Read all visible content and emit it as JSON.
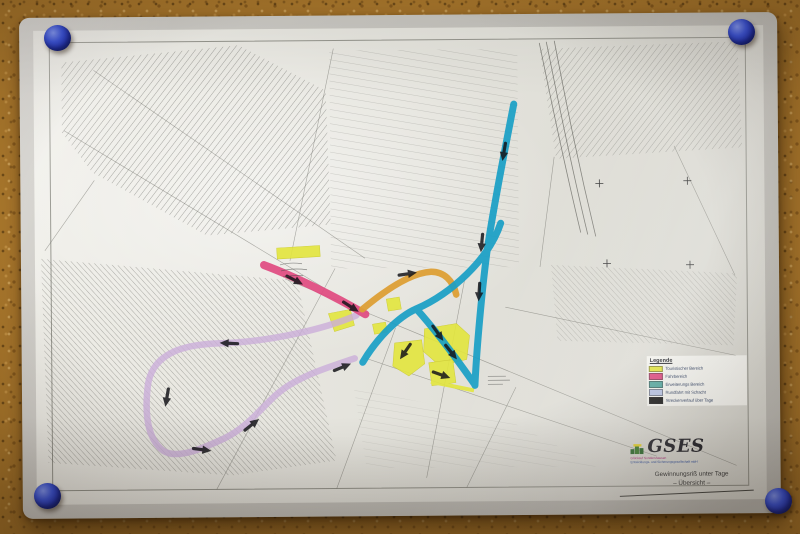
{
  "scene": {
    "description": "Laminated underground mine overview map fixed to a cork board with four round push pins",
    "board_color": "#a9772c",
    "pin_color": "#2b3cc0",
    "icons": {
      "push_pin": "round-head-pin"
    }
  },
  "map": {
    "legend": {
      "title": "Legende",
      "entries": [
        {
          "label": "Touristischer Bereich",
          "color": "#e3e63e"
        },
        {
          "label": "Fahrbereich",
          "color": "#df4a80"
        },
        {
          "label": "Erweiterungs Bereich",
          "color": "#55a8a0"
        },
        {
          "label": "Rundfahrt mit Schacht",
          "color": "#b9c5e6"
        },
        {
          "label": "Streckenverlauf über Tage",
          "color": "#1a1a1a"
        }
      ]
    },
    "title_block": {
      "logo_text": "GSES",
      "logo_subline1": "Glückauf Sondershausen",
      "logo_subline2": "Entwicklungs- und Sicherungsgesellschaft mbH",
      "caption_line1": "Gewinnungsriß unter Tage",
      "caption_line2": "– Übersicht –"
    },
    "route_colors": {
      "tourist_area_yellow": "#e3e63e",
      "magenta_route": "#df4a80",
      "orange_route": "#dd9f35",
      "cyan_route": "#199fc6",
      "violet_loop": "#cbaed9"
    }
  }
}
